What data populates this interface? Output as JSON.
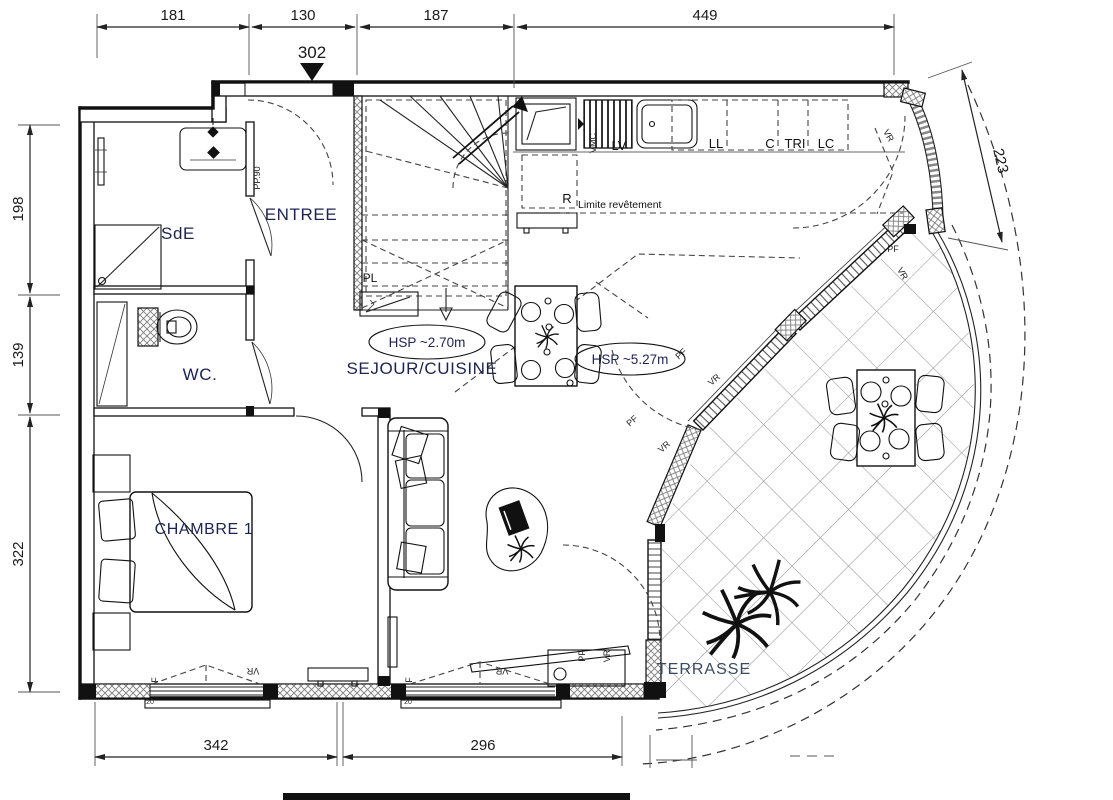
{
  "dimensions": {
    "top": [
      "181",
      "130",
      "187",
      "449"
    ],
    "left": [
      "198",
      "139",
      "322"
    ],
    "bottom": [
      "342",
      "296"
    ],
    "right": "223",
    "entry_marker": "302"
  },
  "rooms": {
    "sde": "SdE",
    "entree": "ENTREE",
    "wc": "WC.",
    "chambre": "CHAMBRE 1",
    "sejour": "SEJOUR/CUISINE",
    "terrasse": "TERRASSE"
  },
  "annotations": {
    "hsp_sejour": "HSP ~2.70m",
    "hsp_double": "HSP ~5.27m",
    "limite_revetement": "Limite revêtement",
    "porte_palier": "PP.90",
    "placard": "PL",
    "vmc": "VMC",
    "refrigerateur": "R",
    "lave_vaisselle": "LV",
    "lave_linge": "LL",
    "cellier": "C",
    "tri": "TRI",
    "lave_chauffe": "LC"
  },
  "window_labels": {
    "f": "F",
    "vr": "VR",
    "pf": "PF",
    "sill": "20"
  },
  "colors": {
    "label_color": "#1c2350",
    "terrasse_color": "#3a4a5e",
    "line_color": "#1a1a1a",
    "dash_color": "#444444",
    "hatch_color": "#8a8a8a"
  }
}
